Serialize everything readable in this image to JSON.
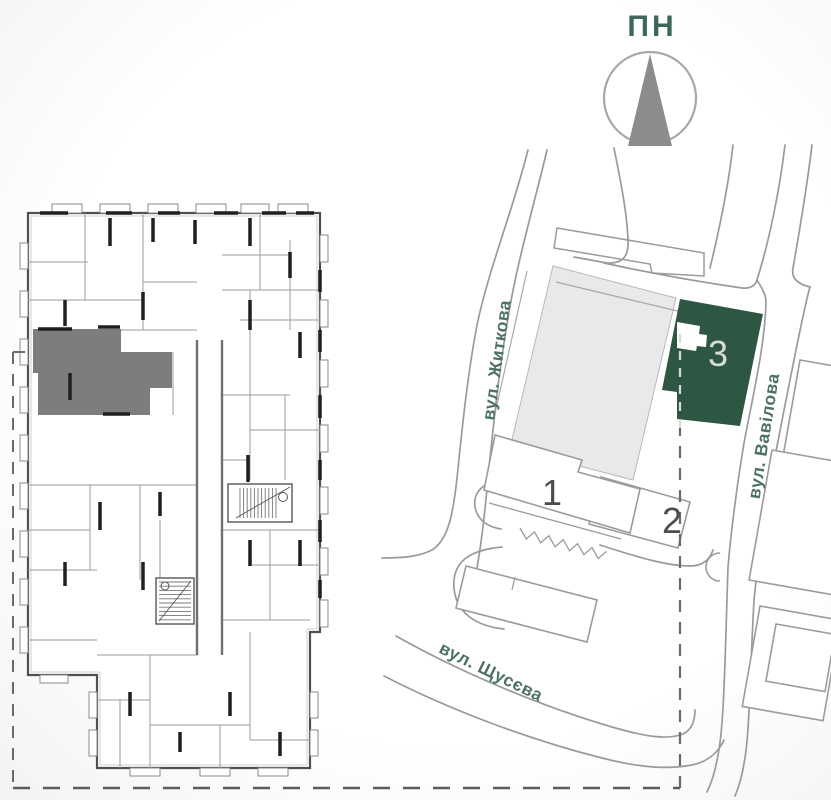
{
  "title": "Residential complex site plan with highlighted floor-plan unit",
  "compass": {
    "north_label": "ПН"
  },
  "site_plan": {
    "streets": [
      {
        "id": "zhytkova",
        "label": "вул. Житкова"
      },
      {
        "id": "vavilova",
        "label": "вул. Вавілова"
      },
      {
        "id": "shchusieva",
        "label": "вул. Щусєва"
      }
    ],
    "buildings": [
      {
        "id": "building-1",
        "number": "1",
        "highlighted": false
      },
      {
        "id": "building-2",
        "number": "2",
        "highlighted": false
      },
      {
        "id": "building-3",
        "number": "3",
        "highlighted": true
      }
    ],
    "colors": {
      "highlighted_building": "#2e5743",
      "building_number_light": "#d5ddd6",
      "building_number_dark": "#4d4d4d",
      "street_label": "#4d7265",
      "north_label": "#3d685a",
      "compass_arrow": "#8c8c8c",
      "neighbor_block_fill": "#e9e9ec"
    }
  },
  "floor_plan": {
    "highlighted_unit_color": "#7d7d7f"
  }
}
